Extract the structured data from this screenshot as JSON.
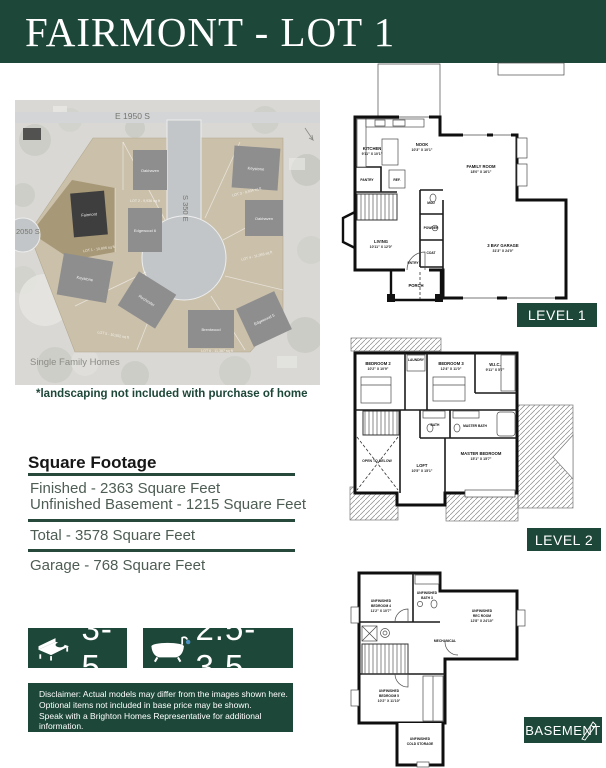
{
  "header": {
    "title": "FAIRMONT - LOT 1"
  },
  "site_map": {
    "street_top": "E 1950 S",
    "street_vertical": "S 350 E",
    "street_left": "2050 S",
    "caption": "Single Family Homes",
    "houses": [
      {
        "label": "Oakhaven"
      },
      {
        "label": "Keystone"
      },
      {
        "label": "Fairmont"
      },
      {
        "label": "Edgewood 6"
      },
      {
        "label": "Oakhaven"
      },
      {
        "label": "Keystone"
      },
      {
        "label": "Rochester"
      },
      {
        "label": "Brentwood"
      },
      {
        "label": "Edgewood 5"
      }
    ],
    "lot_labels": [
      "LOT 1 - 10,806 sq ft",
      "LOT 2 - 9,936 sq ft",
      "LOT 3 - 9,934 sq ft",
      "LOT 4 - 11,093 sq ft",
      "LOT 5 - 10,552 sq ft",
      "LOT 6 - 11,387 sq ft"
    ]
  },
  "landscaping_note": "*landscaping not included with purchase of home",
  "square_footage": {
    "heading": "Square Footage",
    "finished": "Finished - 2363 Square Feet",
    "unfinished_basement": "Unfinished Basement - 1215 Square Feet",
    "total": "Total - 3578 Square Feet",
    "garage": "Garage - 768 Square Feet"
  },
  "stats": {
    "beds": "3-5",
    "baths": "2.5-3.5"
  },
  "disclaimer": {
    "line1": "Disclaimer: Actual models may differ from the images shown here.",
    "line2": "Optional items not included in base price may be shown.",
    "line3": "Speak with a Brighton Homes Representative for additional information.",
    "line4": "Areas and dimensions are approximate."
  },
  "floorplans": {
    "level1": {
      "badge": "LEVEL 1",
      "rooms": {
        "kitchen": {
          "name": "KITCHEN",
          "dims": "9'11\" X 10'1\""
        },
        "nook": {
          "name": "NOOK",
          "dims": "10'3\" X 10'1\""
        },
        "family": {
          "name": "FAMILY ROOM",
          "dims": "18'0\" X 16'1\""
        },
        "pantry": {
          "name": "PANTRY"
        },
        "ref": {
          "name": "REF."
        },
        "mud": {
          "name": "MUD"
        },
        "powder": {
          "name": "POWDER"
        },
        "coat": {
          "name": "COAT"
        },
        "entry": {
          "name": "ENTRY"
        },
        "living": {
          "name": "LIVING",
          "dims": "10'11\" X 12'0\""
        },
        "porch": {
          "name": "PORCH"
        },
        "garage": {
          "name": "3 BAY GARAGE",
          "dims": "31'3\" X 24'0\""
        }
      }
    },
    "level2": {
      "badge": "LEVEL 2",
      "rooms": {
        "bedroom2": {
          "name": "BEDROOM 2",
          "dims": "10'2\" X 10'9\""
        },
        "laundry": {
          "name": "LAUNDRY"
        },
        "bedroom3": {
          "name": "BEDROOM 3",
          "dims": "12'4\" X 11'0\""
        },
        "wic": {
          "name": "W.I.C.",
          "dims": "9'11\" X 5'7\""
        },
        "bath": {
          "name": "BATH"
        },
        "master_bath": {
          "name": "MASTER BATH"
        },
        "open_below": {
          "name": "OPEN TO BELOW"
        },
        "loft": {
          "name": "LOFT",
          "dims": "10'5\" X 15'1\""
        },
        "master": {
          "name": "MASTER BEDROOM",
          "dims": "15'1\" X 15'7\""
        }
      }
    },
    "basement": {
      "badge": "BASEMENT",
      "rooms": {
        "bedroom4": {
          "name": "UNFINISHED",
          "name2": "BEDROOM 4",
          "dims": "11'2\" X 10'7\""
        },
        "bath3": {
          "name": "UNFINISHED",
          "name2": "BATH 3"
        },
        "rec": {
          "name": "UNFINISHED",
          "name2": "REC ROOM",
          "dims": "12'8\" X 24'10\""
        },
        "mechanical": {
          "name": "MECHANICAL"
        },
        "bedroom5": {
          "name": "UNFINISHED",
          "name2": "BEDROOM 5",
          "dims": "10'2\" X 11'10\""
        },
        "cold": {
          "name": "UNFINISHED",
          "name2": "COLD STORAGE"
        }
      }
    }
  },
  "colors": {
    "brand_green": "#1d4738",
    "water_blue": "#4a90c4"
  }
}
